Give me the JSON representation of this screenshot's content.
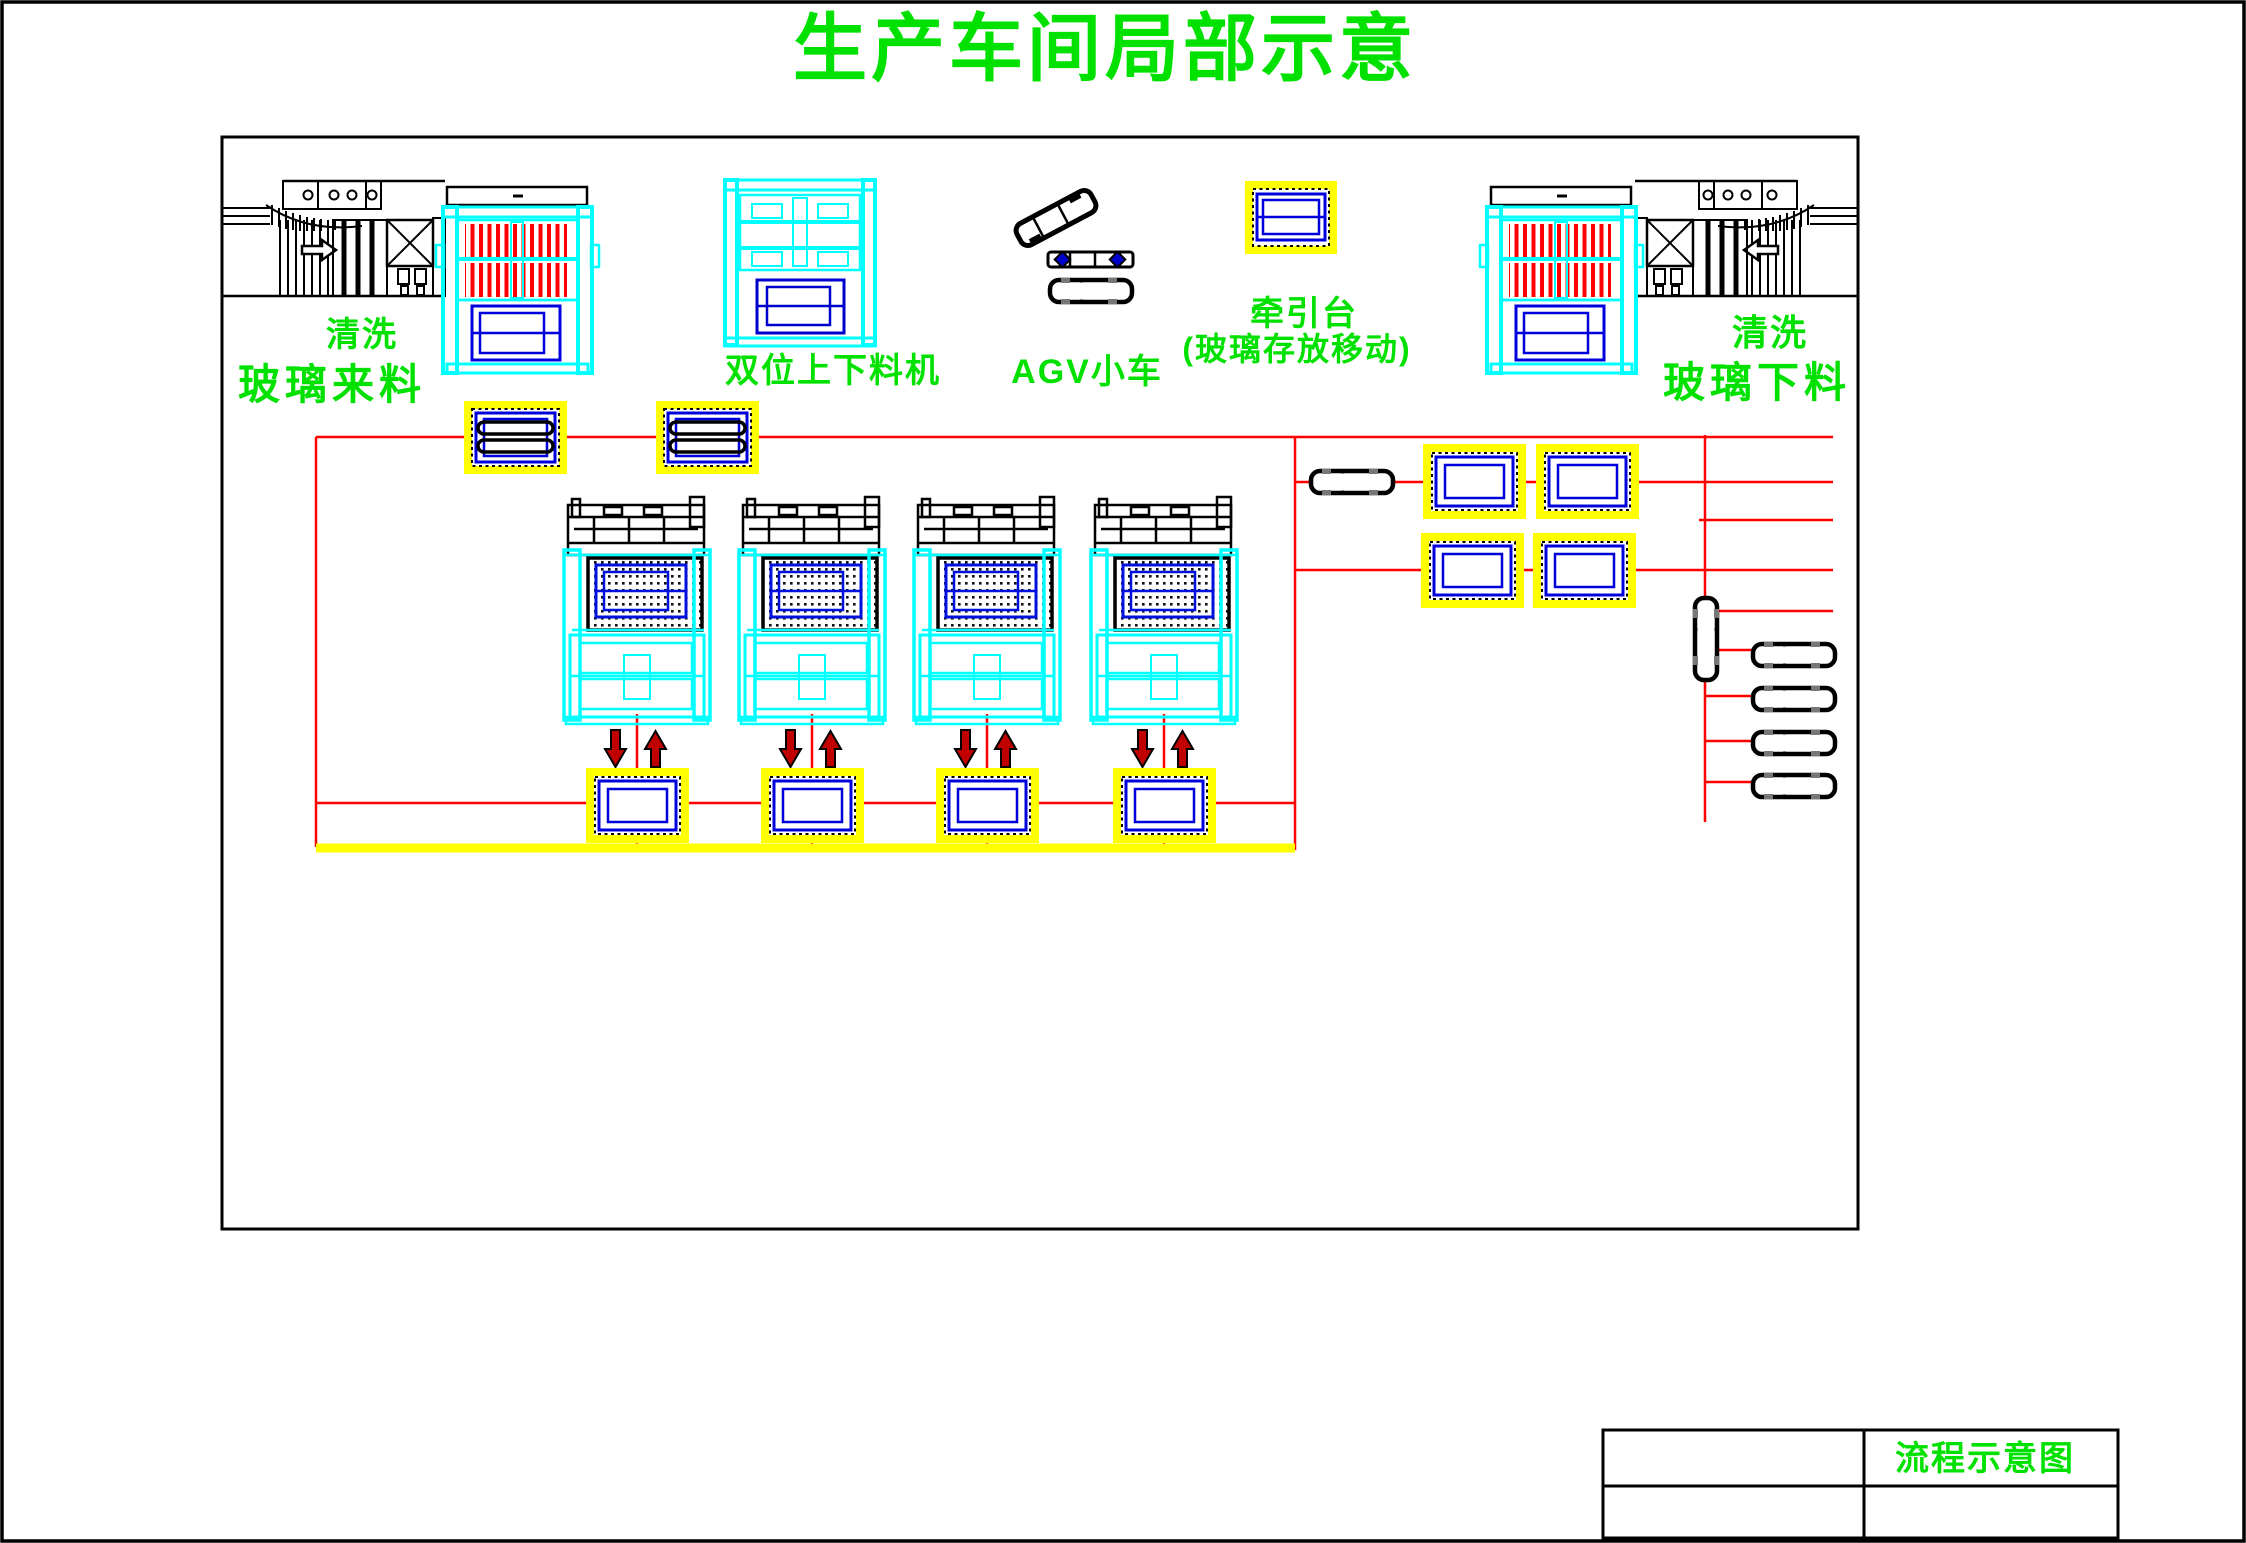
{
  "page_title": "生产车间局部示意",
  "colors": {
    "label_green": "#00E100",
    "machine_cyan": "#00FFFF",
    "detail_blue": "#0000DD",
    "flow_red": "#FF0000",
    "highlight_yellow": "#FFFF00",
    "arrow_dark_red": "#C00000",
    "line_black": "#000000"
  },
  "labels": {
    "wash_left": "清洗",
    "glass_infeed": "玻璃来料",
    "dual_loader": "双位上下料机",
    "agv_cart": "AGV小车",
    "traction_table": "牵引台",
    "traction_table_note": "(玻璃存放移动)",
    "wash_right": "清洗",
    "glass_outfeed": "玻璃下料"
  },
  "title_block": {
    "drawing_title": "流程示意图"
  }
}
